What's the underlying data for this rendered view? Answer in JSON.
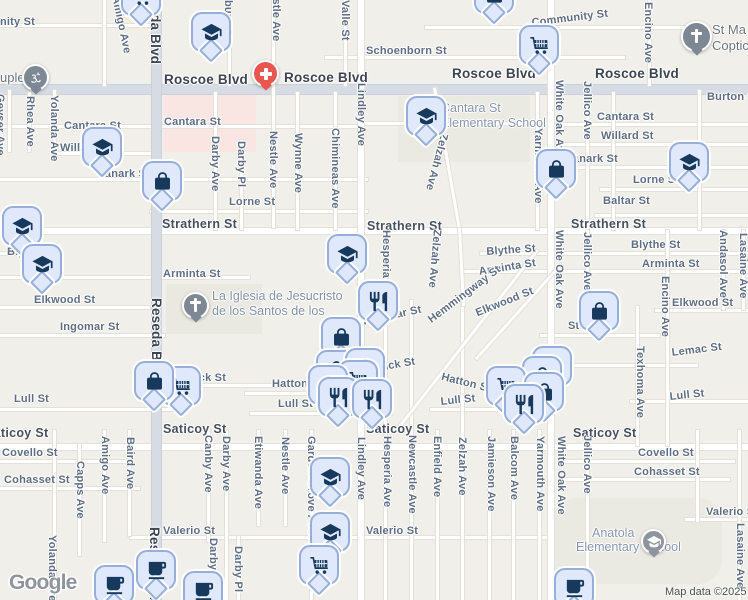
{
  "map": {
    "attribution": {
      "logo": "Google",
      "map_data": "Map data ©2025"
    },
    "colors": {
      "land": "#f0efe9",
      "road_minor": "#ffffff",
      "road_major": "#d7dce4",
      "marker_fill": "#dfe9fb",
      "marker_border": "#96aed8",
      "marker_glyph": "#17395c",
      "poi_grey": "#7e8794",
      "hospital_red": "#e8564e",
      "commercial_pink": "#f9e5e2"
    },
    "marker_names": {
      "school": "school",
      "bag": "shopping-bag",
      "cart": "grocery-cart",
      "restaurant": "restaurant",
      "cafe": "cafe"
    },
    "labels": [
      {
        "t": "nity St",
        "x": 0,
        "y": 16
      },
      {
        "t": "Community St",
        "x": 531,
        "y": 17,
        "r": -7
      },
      {
        "t": "Schoenborn St",
        "x": 366,
        "y": 45
      },
      {
        "t": "Roscoe Blvd",
        "x": 164,
        "y": 72,
        "k": "blvd"
      },
      {
        "t": "Roscoe Blvd",
        "x": 284,
        "y": 70,
        "k": "blvd"
      },
      {
        "t": "Roscoe Blvd",
        "x": 452,
        "y": 66,
        "k": "blvd"
      },
      {
        "t": "Roscoe Blvd",
        "x": 595,
        "y": 66,
        "k": "blvd"
      },
      {
        "t": "Burton St",
        "x": 707,
        "y": 91
      },
      {
        "t": "Cantara St",
        "x": 64,
        "y": 120
      },
      {
        "t": "Cantara St",
        "x": 164,
        "y": 116
      },
      {
        "t": "Cantara St",
        "x": 597,
        "y": 111
      },
      {
        "t": "Willard St",
        "x": 60,
        "y": 142
      },
      {
        "t": "Willard St",
        "x": 601,
        "y": 130
      },
      {
        "t": "Lanark St",
        "x": 98,
        "y": 168
      },
      {
        "t": "Lanark St",
        "x": 566,
        "y": 153
      },
      {
        "t": "Lorne St",
        "x": 229,
        "y": 196
      },
      {
        "t": "Lorne St",
        "x": 633,
        "y": 174
      },
      {
        "t": "Baltar St",
        "x": 603,
        "y": 195
      },
      {
        "t": "Strathern St",
        "x": 162,
        "y": 217,
        "k": "mid"
      },
      {
        "t": "Strathern St",
        "x": 367,
        "y": 219,
        "k": "mid"
      },
      {
        "t": "Strathern St",
        "x": 571,
        "y": 217,
        "k": "mid"
      },
      {
        "t": "Blythe St",
        "x": 7,
        "y": 246
      },
      {
        "t": "Blythe St",
        "x": 486,
        "y": 246,
        "r": -4
      },
      {
        "t": "Blythe St",
        "x": 631,
        "y": 239
      },
      {
        "t": "Arminta St",
        "x": 163,
        "y": 268
      },
      {
        "t": "Arminta St",
        "x": 478,
        "y": 266,
        "r": -9
      },
      {
        "t": "Arminta St",
        "x": 642,
        "y": 258
      },
      {
        "t": "Elkwood St",
        "x": 34,
        "y": 294
      },
      {
        "t": "Elkwood St",
        "x": 474,
        "y": 308,
        "r": -22
      },
      {
        "t": "Elkwood St",
        "x": 672,
        "y": 297
      },
      {
        "t": "Ingomar St",
        "x": 60,
        "y": 321
      },
      {
        "t": "Ingomar St",
        "x": 362,
        "y": 316,
        "r": -12
      },
      {
        "t": "Hemmingway St",
        "x": 426,
        "y": 316,
        "r": -37
      },
      {
        "t": "Stagg St",
        "x": 568,
        "y": 320
      },
      {
        "t": "Keswick St",
        "x": 166,
        "y": 372
      },
      {
        "t": "Keswick St",
        "x": 355,
        "y": 366,
        "r": -10
      },
      {
        "t": "Hatton St",
        "x": 272,
        "y": 378
      },
      {
        "t": "Hatton St",
        "x": 443,
        "y": 371,
        "r": 14
      },
      {
        "t": "Lull St",
        "x": 14,
        "y": 393
      },
      {
        "t": "Lull St",
        "x": 278,
        "y": 398
      },
      {
        "t": "Lull St",
        "x": 440,
        "y": 396,
        "r": -6
      },
      {
        "t": "Lull St",
        "x": 669,
        "y": 391,
        "r": -6
      },
      {
        "t": "Lemac St",
        "x": 671,
        "y": 347,
        "r": -7
      },
      {
        "t": "Saticoy St",
        "x": -15,
        "y": 426,
        "k": "mid"
      },
      {
        "t": "Saticoy St",
        "x": 163,
        "y": 422,
        "k": "mid"
      },
      {
        "t": "Saticoy St",
        "x": 366,
        "y": 422,
        "k": "mid"
      },
      {
        "t": "Saticoy St",
        "x": 573,
        "y": 426,
        "k": "mid"
      },
      {
        "t": "Covello St",
        "x": 2,
        "y": 447
      },
      {
        "t": "Covello St",
        "x": 638,
        "y": 447
      },
      {
        "t": "Cohasset St",
        "x": 4,
        "y": 474
      },
      {
        "t": "Cohasset St",
        "x": 634,
        "y": 466
      },
      {
        "t": "Valerio St",
        "x": 163,
        "y": 525
      },
      {
        "t": "Valerio St",
        "x": 366,
        "y": 525
      },
      {
        "t": "Valerio St",
        "x": 706,
        "y": 506
      },
      {
        "t": "Geyser Ave",
        "x": 6,
        "y": 94,
        "r": 90
      },
      {
        "t": "Rhea Ave",
        "x": 36,
        "y": 96,
        "r": 90
      },
      {
        "t": "Yolanda Ave",
        "x": 60,
        "y": 95,
        "r": 90
      },
      {
        "t": "Yolanda Ave",
        "x": 58,
        "y": 535,
        "r": 90
      },
      {
        "t": "Capps Ave",
        "x": 86,
        "y": 461,
        "r": 90
      },
      {
        "t": "Amigo Ave",
        "x": 121,
        "y": -5,
        "r": 78
      },
      {
        "t": "Amigo Ave",
        "x": 111,
        "y": 436,
        "r": 90
      },
      {
        "t": "Baird Ave",
        "x": 136,
        "y": 437,
        "r": 90
      },
      {
        "t": "Reseda Blvd",
        "x": 163,
        "y": -19,
        "r": 90,
        "k": "blvd"
      },
      {
        "t": "Reseda Blvd",
        "x": 164,
        "y": 298,
        "r": 90,
        "k": "blvd"
      },
      {
        "t": "Reseda Blvd",
        "x": 162,
        "y": 527,
        "r": 90,
        "k": "blvd"
      },
      {
        "t": "Canby Ave",
        "x": 214,
        "y": 435,
        "r": 90
      },
      {
        "t": "Darby Ave",
        "x": 221,
        "y": 136,
        "r": 90
      },
      {
        "t": "Darby Ave",
        "x": 232,
        "y": 436,
        "r": 90
      },
      {
        "t": "Darby Ave",
        "x": 219,
        "y": 538,
        "r": 90
      },
      {
        "t": "Darby Pl",
        "x": 247,
        "y": 141,
        "r": 90
      },
      {
        "t": "Darby Pl",
        "x": 244,
        "y": 546,
        "r": 90
      },
      {
        "t": "burn Ave",
        "x": 234,
        "y": 0,
        "r": 90
      },
      {
        "t": "Etiwanda Ave",
        "x": 264,
        "y": 436,
        "r": 90
      },
      {
        "t": "Nestle Ave",
        "x": 282,
        "y": -16,
        "r": 90
      },
      {
        "t": "Nestle Ave",
        "x": 279,
        "y": 131,
        "r": 90
      },
      {
        "t": "Nestle Ave",
        "x": 291,
        "y": 437,
        "r": 90
      },
      {
        "t": "Wynne Ave",
        "x": 304,
        "y": 133,
        "r": 90
      },
      {
        "t": "Garden Grove Ave",
        "x": 317,
        "y": 436,
        "r": 90
      },
      {
        "t": "Chimineas Ave",
        "x": 341,
        "y": 128,
        "r": 90
      },
      {
        "t": "Valle St",
        "x": 351,
        "y": 0,
        "r": 90
      },
      {
        "t": "Lindley Ave",
        "x": 367,
        "y": 83,
        "r": 90
      },
      {
        "t": "Lindley Ave",
        "x": 367,
        "y": 437,
        "r": 90
      },
      {
        "t": "Hesperia Ave",
        "x": 392,
        "y": 230,
        "r": 90
      },
      {
        "t": "Hesperia Ave",
        "x": 393,
        "y": 436,
        "r": 90
      },
      {
        "t": "Newcastle Ave",
        "x": 418,
        "y": 435,
        "r": 90
      },
      {
        "t": "Zelzah Ave",
        "x": 450,
        "y": 135,
        "r": 105
      },
      {
        "t": "Zelzah Ave",
        "x": 443,
        "y": 230,
        "r": 95
      },
      {
        "t": "Zelzah Ave",
        "x": 468,
        "y": 437,
        "r": 90
      },
      {
        "t": "Enfield Ave",
        "x": 443,
        "y": 436,
        "r": 90
      },
      {
        "t": "Jamieson Ave",
        "x": 497,
        "y": 436,
        "r": 90
      },
      {
        "t": "Balcom Ave",
        "x": 520,
        "y": 436,
        "r": 90
      },
      {
        "t": "Yarmouth Ave",
        "x": 544,
        "y": 128,
        "r": 90
      },
      {
        "t": "Yarmouth Ave",
        "x": 546,
        "y": 436,
        "r": 90
      },
      {
        "t": "White Oak Ave",
        "x": 565,
        "y": 80,
        "r": 90
      },
      {
        "t": "White Oak Ave",
        "x": 565,
        "y": 230,
        "r": 90
      },
      {
        "t": "White Oak Ave",
        "x": 567,
        "y": 436,
        "r": 90
      },
      {
        "t": "Jellico Ave",
        "x": 593,
        "y": 81,
        "r": 90
      },
      {
        "t": "Jellico Ave",
        "x": 593,
        "y": 232,
        "r": 90
      },
      {
        "t": "Jellico Ave",
        "x": 593,
        "y": 435,
        "r": 90
      },
      {
        "t": "Texhoma Ave",
        "x": 646,
        "y": 346,
        "r": 90
      },
      {
        "t": "Encino Ave",
        "x": 654,
        "y": 2,
        "r": 90
      },
      {
        "t": "Encino Ave",
        "x": 671,
        "y": 276,
        "r": 90
      },
      {
        "t": "Andasol Ave",
        "x": 729,
        "y": 230,
        "r": 90
      },
      {
        "t": "Lasaine Ave",
        "x": 749,
        "y": 233,
        "r": 90
      },
      {
        "t": "Lasaine Ave",
        "x": 746,
        "y": 523,
        "r": 90
      },
      {
        "t": "uple",
        "x": 0,
        "y": 70,
        "k": "place",
        "n": "poi-label"
      },
      {
        "t": "St Ma",
        "x": 712,
        "y": 22,
        "k": "place",
        "n": "poi-label"
      },
      {
        "t": "Coptic",
        "x": 712,
        "y": 38,
        "k": "place",
        "n": "poi-label"
      },
      {
        "t": "La Iglesia de Jesucristo",
        "x": 212,
        "y": 289,
        "k": "church",
        "n": "poi-label"
      },
      {
        "t": "de los Santos de los",
        "x": 212,
        "y": 304,
        "k": "church",
        "n": "poi-label"
      },
      {
        "t": "Cantara St",
        "x": 441,
        "y": 101,
        "k": "school",
        "n": "poi-label"
      },
      {
        "t": "Elementary School",
        "x": 441,
        "y": 116,
        "k": "school",
        "n": "poi-label"
      },
      {
        "t": "Anatola",
        "x": 592,
        "y": 526,
        "k": "school",
        "n": "poi-label"
      },
      {
        "t": "Elementary School",
        "x": 576,
        "y": 540,
        "k": "school",
        "n": "poi-label"
      }
    ],
    "markers": [
      {
        "i": "cart",
        "x": 121,
        "y": -24
      },
      {
        "i": "bag",
        "x": 474,
        "y": -26
      },
      {
        "i": "school",
        "x": 191,
        "y": 12
      },
      {
        "i": "cart",
        "x": 519,
        "y": 25
      },
      {
        "i": "school",
        "x": 406,
        "y": 96
      },
      {
        "i": "school",
        "x": 82,
        "y": 127
      },
      {
        "i": "bag",
        "x": 142,
        "y": 161
      },
      {
        "i": "bag",
        "x": 536,
        "y": 149
      },
      {
        "i": "school",
        "x": 669,
        "y": 142
      },
      {
        "i": "school",
        "x": 2,
        "y": 206
      },
      {
        "i": "school",
        "x": 22,
        "y": 244
      },
      {
        "i": "school",
        "x": 327,
        "y": 234
      },
      {
        "i": "restaurant",
        "x": 358,
        "y": 281
      },
      {
        "i": "bag",
        "x": 579,
        "y": 291
      },
      {
        "i": "bag",
        "x": 321,
        "y": 317
      },
      {
        "i": "bag",
        "x": 316,
        "y": 350
      },
      {
        "i": "bag",
        "x": 345,
        "y": 348
      },
      {
        "i": "cart",
        "x": 338,
        "y": 360
      },
      {
        "i": "bag",
        "x": 308,
        "y": 365
      },
      {
        "i": "restaurant",
        "x": 318,
        "y": 377
      },
      {
        "i": "restaurant",
        "x": 352,
        "y": 379
      },
      {
        "i": "cart",
        "x": 161,
        "y": 366
      },
      {
        "i": "bag",
        "x": 134,
        "y": 361
      },
      {
        "i": "cart",
        "x": 532,
        "y": 346
      },
      {
        "i": "bag",
        "x": 522,
        "y": 356
      },
      {
        "i": "cart",
        "x": 486,
        "y": 366
      },
      {
        "i": "bag",
        "x": 524,
        "y": 372
      },
      {
        "i": "restaurant",
        "x": 504,
        "y": 384
      },
      {
        "i": "school",
        "x": 310,
        "y": 457
      },
      {
        "i": "school",
        "x": 310,
        "y": 512
      },
      {
        "i": "cart",
        "x": 299,
        "y": 545
      },
      {
        "i": "cafe",
        "x": 94,
        "y": 565
      },
      {
        "i": "cafe",
        "x": 136,
        "y": 550
      },
      {
        "i": "cafe",
        "x": 183,
        "y": 571
      },
      {
        "i": "cafe",
        "x": 554,
        "y": 568
      }
    ],
    "poi_dots": [
      {
        "i": "om",
        "x": 22,
        "y": 64,
        "c": "#7e8794",
        "n": "hindu-temple-poi"
      },
      {
        "i": "plus",
        "x": 252,
        "y": 60,
        "c": "#e8564e",
        "n": "hospital-poi"
      },
      {
        "i": "cross",
        "x": 681,
        "y": 21,
        "c": "#7e8794",
        "n": "church-poi",
        "s": 31
      },
      {
        "i": "cross",
        "x": 182,
        "y": 292,
        "c": "#7e8794",
        "n": "church-poi"
      },
      {
        "i": "cap",
        "x": 641,
        "y": 529,
        "c": "#8d949d",
        "n": "school-poi",
        "s": 25
      }
    ]
  }
}
